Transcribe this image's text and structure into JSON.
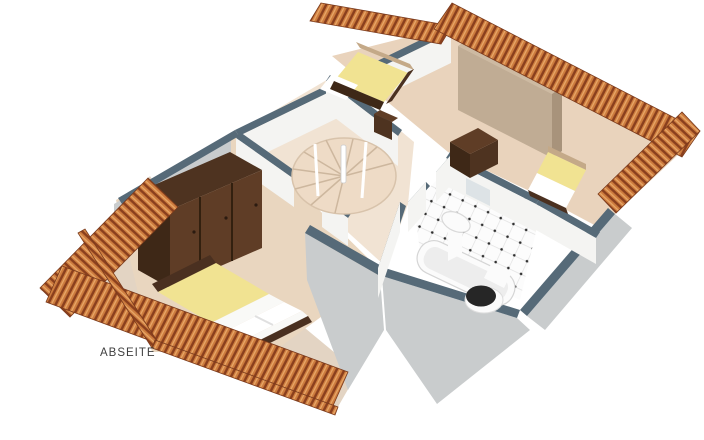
{
  "scene": {
    "type": "isometric-3d-floorplan",
    "floor_label": "ABSEITE"
  },
  "labels": {
    "abseite": "ABSEITE"
  },
  "colors": {
    "background": "#ffffff",
    "floor_main": "#e9d3bc",
    "floor_hall": "#f1e3d3",
    "floor_bed1": "#e9d6bf",
    "floor_abseite": "#e3d4c3",
    "wall_top": "#566a78",
    "wall_face": "#f4f4f2",
    "wall_face_ext": "#c9cccd",
    "roof_base": "#cd7c3e",
    "roof_dark": "#8a3f1d",
    "roof_light": "#e9a869",
    "wood_dark_top": "#4e3320",
    "wood_dark_front": "#5f3d26",
    "wood_dark_side": "#3e2817",
    "tan_top": "#cdbaa2",
    "tan_face": "#c0ac94",
    "tan_side": "#a8937b",
    "bed_yellow": "#f1e392",
    "bed_sheet": "#f9f9f7",
    "bed_frame": "#4a3020",
    "headboard_tan": "#c4a988",
    "stair_step": "#eedbc6",
    "fixture_white": "#fbfbfb",
    "fixture_inner": "#ededed",
    "seat_black": "#262626",
    "mirror": "#dde3e6",
    "label_text": "#3f3f3f"
  },
  "elements": {
    "rooms": [
      "bedroom-left",
      "hallway-spiral-stair",
      "bedroom-top",
      "bedroom-right-nook",
      "bathroom",
      "abseite-attic-strip"
    ],
    "furniture": [
      "wardrobe-3-door",
      "double-bed",
      "single-bed-top",
      "single-bed-right",
      "large-cabinet-back",
      "dresser",
      "nightstand",
      "spiral-staircase",
      "bathtub",
      "toilet",
      "washbasin",
      "mirror"
    ]
  }
}
